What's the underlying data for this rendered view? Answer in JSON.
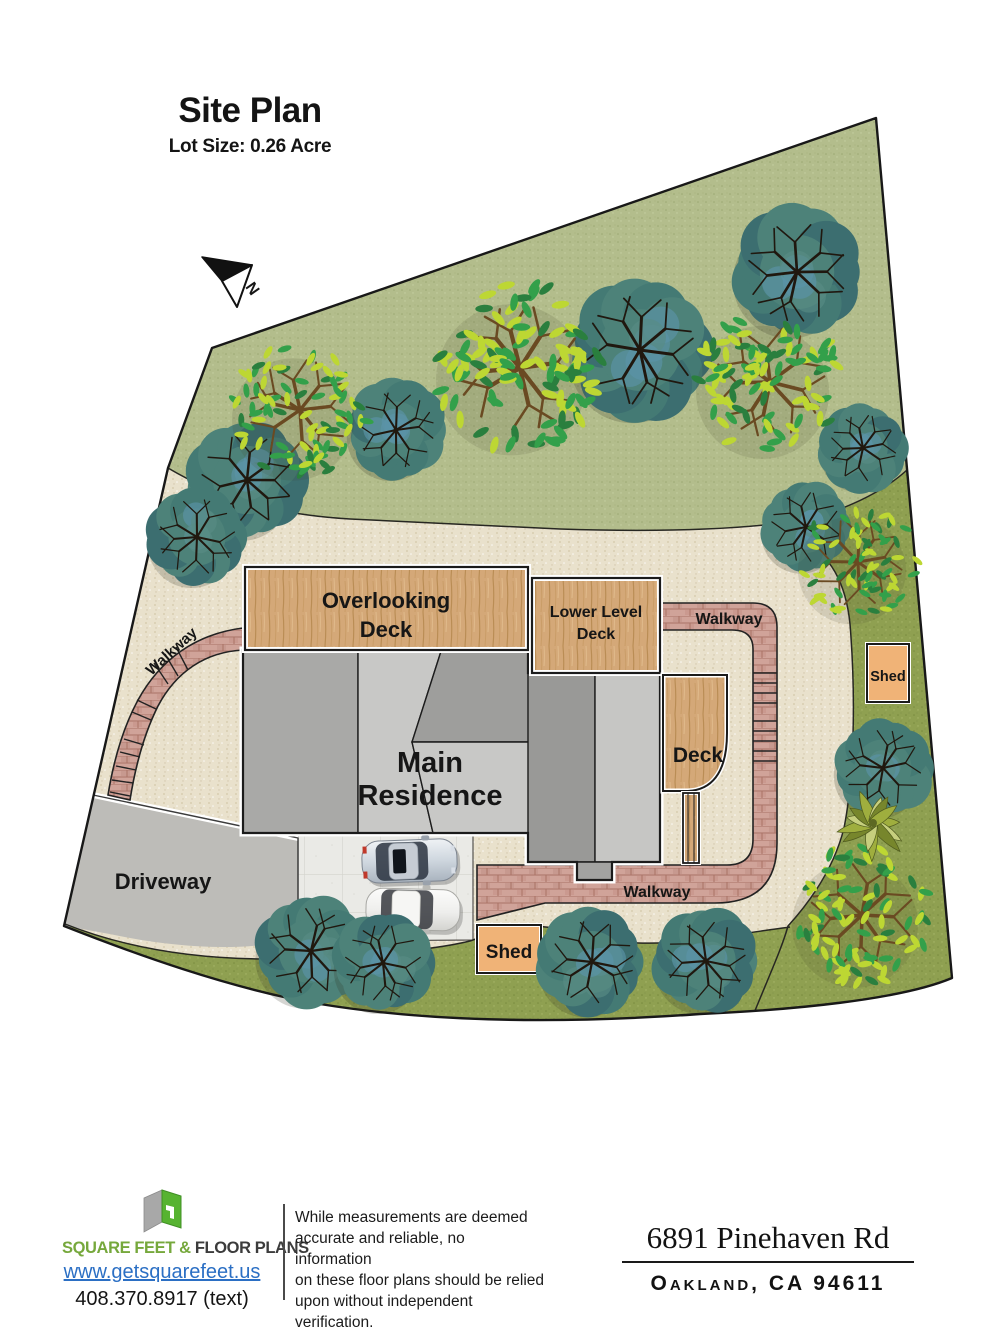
{
  "title": "Site Plan",
  "subtitle": "Lot Size: 0.26 Acre",
  "compass": {
    "label": "N"
  },
  "plan": {
    "labels": {
      "overlooking_deck_line1": "Overlooking",
      "overlooking_deck_line2": "Deck",
      "lower_level_deck_line1": "Lower Level",
      "lower_level_deck_line2": "Deck",
      "main_residence_line1": "Main",
      "main_residence_line2": "Residence",
      "deck": "Deck",
      "walkway_left": "Walkway",
      "walkway_right": "Walkway",
      "walkway_bottom": "Walkway",
      "driveway": "Driveway",
      "shed_right": "Shed",
      "shed_bottom": "Shed"
    },
    "colors": {
      "sand": "#e9e1cc",
      "backyard_grass": "#b3bd8c",
      "lawn_strip": "#8fa051",
      "deck_wood": "#d4a878",
      "brick_walkway": "#d0a399",
      "roof_dark": "#9c9c9a",
      "roof_light": "#c8c8c6",
      "driveway": "#bdbcb8",
      "parking_pad": "#eaeae6",
      "shed": "#f0b377",
      "outline": "#1a1a1a"
    }
  },
  "footer": {
    "brand_green": "SQUARE FEET &",
    "brand_dark": " FLOOR PLANS",
    "website": "www.getsquarefeet.us",
    "phone": "408.370.8917 (text)",
    "disclaimer_lines": [
      "While measurements are deemed",
      "accurate and reliable, no information",
      "on these floor plans should be relied",
      "upon without independent verification."
    ],
    "address_line1": "6891 Pinehaven Rd",
    "address_line2": "Oakland, CA 94611"
  }
}
